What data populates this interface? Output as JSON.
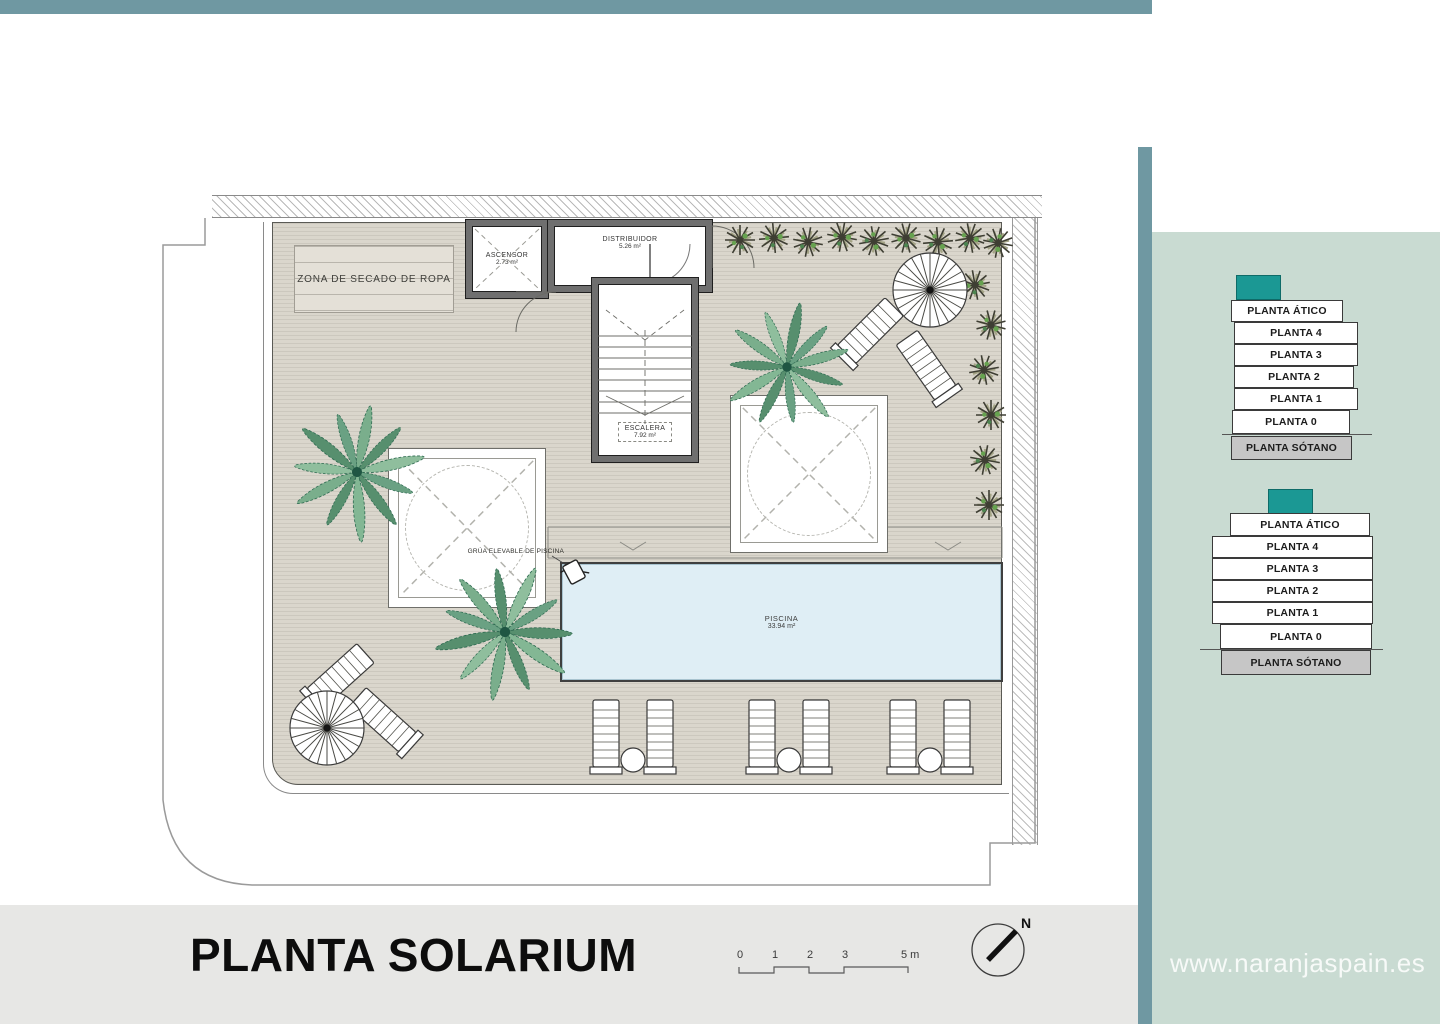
{
  "page": {
    "title": "PLANTA SOLARIUM",
    "watermark": "www.naranjaspain.es"
  },
  "plan": {
    "labels": {
      "drying_zone": "ZONA DE SECADO DE ROPA",
      "crane": "GRÚA ELEVABLE DE PISCINA"
    },
    "rooms": {
      "ascensor": {
        "name": "ASCENSOR",
        "area": "2.73 m²"
      },
      "distribuidor": {
        "name": "DISTRIBUIDOR",
        "area": "5.26 m²"
      },
      "escalera": {
        "name": "ESCALERA",
        "area": "7.92 m²"
      },
      "piscina": {
        "name": "PISCINA",
        "area": "33.94 m²"
      }
    },
    "scale_bar": {
      "ticks": [
        "0",
        "1",
        "2",
        "3"
      ],
      "end_label": "5 m"
    },
    "north_label": "N"
  },
  "sidebar": {
    "stacks": [
      {
        "floors": [
          {
            "label": "PLANTA ÁTICO"
          },
          {
            "label": "PLANTA 4"
          },
          {
            "label": "PLANTA 3"
          },
          {
            "label": "PLANTA 2"
          },
          {
            "label": "PLANTA 1"
          },
          {
            "label": "PLANTA 0"
          },
          {
            "label": "PLANTA SÓTANO"
          }
        ]
      },
      {
        "floors": [
          {
            "label": "PLANTA ÁTICO"
          },
          {
            "label": "PLANTA 4"
          },
          {
            "label": "PLANTA 3"
          },
          {
            "label": "PLANTA 2"
          },
          {
            "label": "PLANTA 1"
          },
          {
            "label": "PLANTA 0"
          },
          {
            "label": "PLANTA SÓTANO"
          }
        ]
      }
    ]
  },
  "colors": {
    "frame_teal": "#6F98A2",
    "sidebar_bg": "#C9DBD2",
    "accent_teal": "#1B9894",
    "sotano_gray": "#C6C6C6",
    "deck": "#DAD6CC",
    "pool_blue": "#DFEEF5",
    "footer_gray": "#E7E7E5"
  }
}
